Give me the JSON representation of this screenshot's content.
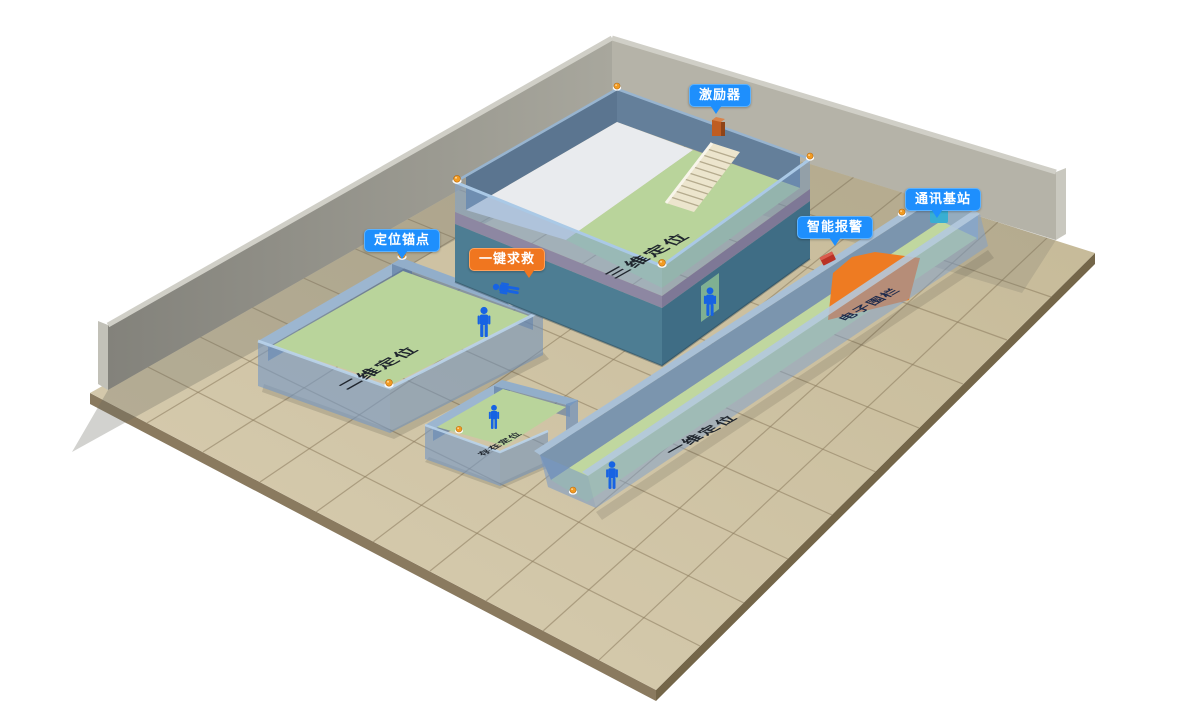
{
  "diagram": {
    "callouts": {
      "exciter": {
        "label": "激励器",
        "color": "#1e8ffd"
      },
      "comm_base_station": {
        "label": "通讯基站",
        "color": "#1e8ffd"
      },
      "smart_alarm": {
        "label": "智能报警",
        "color": "#1e8ffd"
      },
      "positioning_anchor": {
        "label": "定位锚点",
        "color": "#1e8ffd"
      },
      "one_key_sos": {
        "label": "一键求救",
        "color": "#f0761f"
      }
    },
    "zones": {
      "zone_3d": {
        "label": "三维定位"
      },
      "zone_2d": {
        "label": "二维定位"
      },
      "zone_presence": {
        "label": "存在定位"
      },
      "zone_1d": {
        "label": "一维定位"
      },
      "electronic_fence": {
        "label": "电子围栏",
        "color": "#ee7b22"
      }
    },
    "icons": {
      "person": "person-icon",
      "fallen_person": "fallen-person-icon",
      "anchor": "anchor-ball-icon",
      "exciter_device": "exciter-device-icon",
      "base_station_device": "base-station-device-icon",
      "alarm_device": "alarm-device-icon",
      "stairs": "stairs-icon"
    },
    "palette": {
      "ground_tile": "#cfc2a3",
      "back_wall_gray": "#a8a79e",
      "room_wall_blue": "rgba(118,152,196,0.6)",
      "floor_green": "#b9d49b",
      "fence_orange": "#ee7b22",
      "person_blue": "#1763e3",
      "anchor_orange": "#f29b22"
    }
  }
}
